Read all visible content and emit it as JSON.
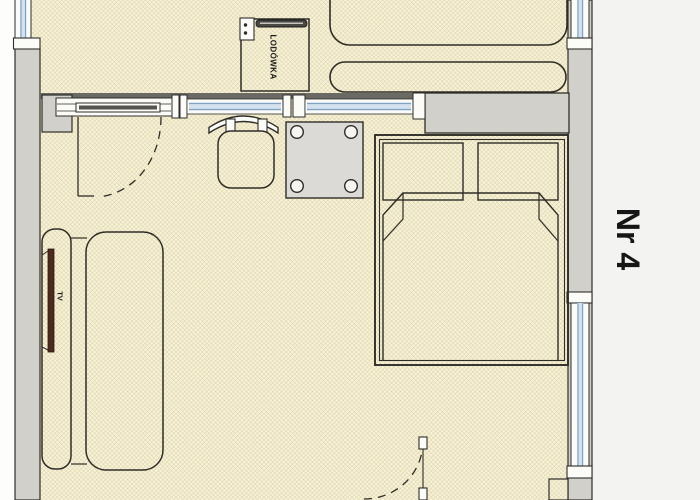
{
  "labels": {
    "room_number": "Nr 4",
    "fridge": "LODÓWKA",
    "tv": "TV"
  },
  "plan": {
    "type": "apartment-floor-plan",
    "rooms": [
      "kitchenette",
      "living-bedroom"
    ],
    "elements": [
      "refrigerator",
      "sofa",
      "dining-table",
      "chair",
      "double-bed",
      "couch",
      "tv",
      "glazed-partition",
      "sliding-panel",
      "interior-door-swing",
      "entry-door-swing",
      "windows"
    ]
  },
  "colors": {
    "floor_bg": "#f7f2db",
    "floor_hatch": "#ddd2a2",
    "wall_gray": "#d2d0ca",
    "outline_dark": "#2f2d28",
    "partition_dark": "#6b6963",
    "glazing_line": "#7fa3c0",
    "glazing_fill": "#d4e2ef",
    "table_gray": "#dbdad6",
    "tv_maroon": "#4e2a1d",
    "paper_right": "#f3f3f1",
    "label_text": "#161616"
  }
}
